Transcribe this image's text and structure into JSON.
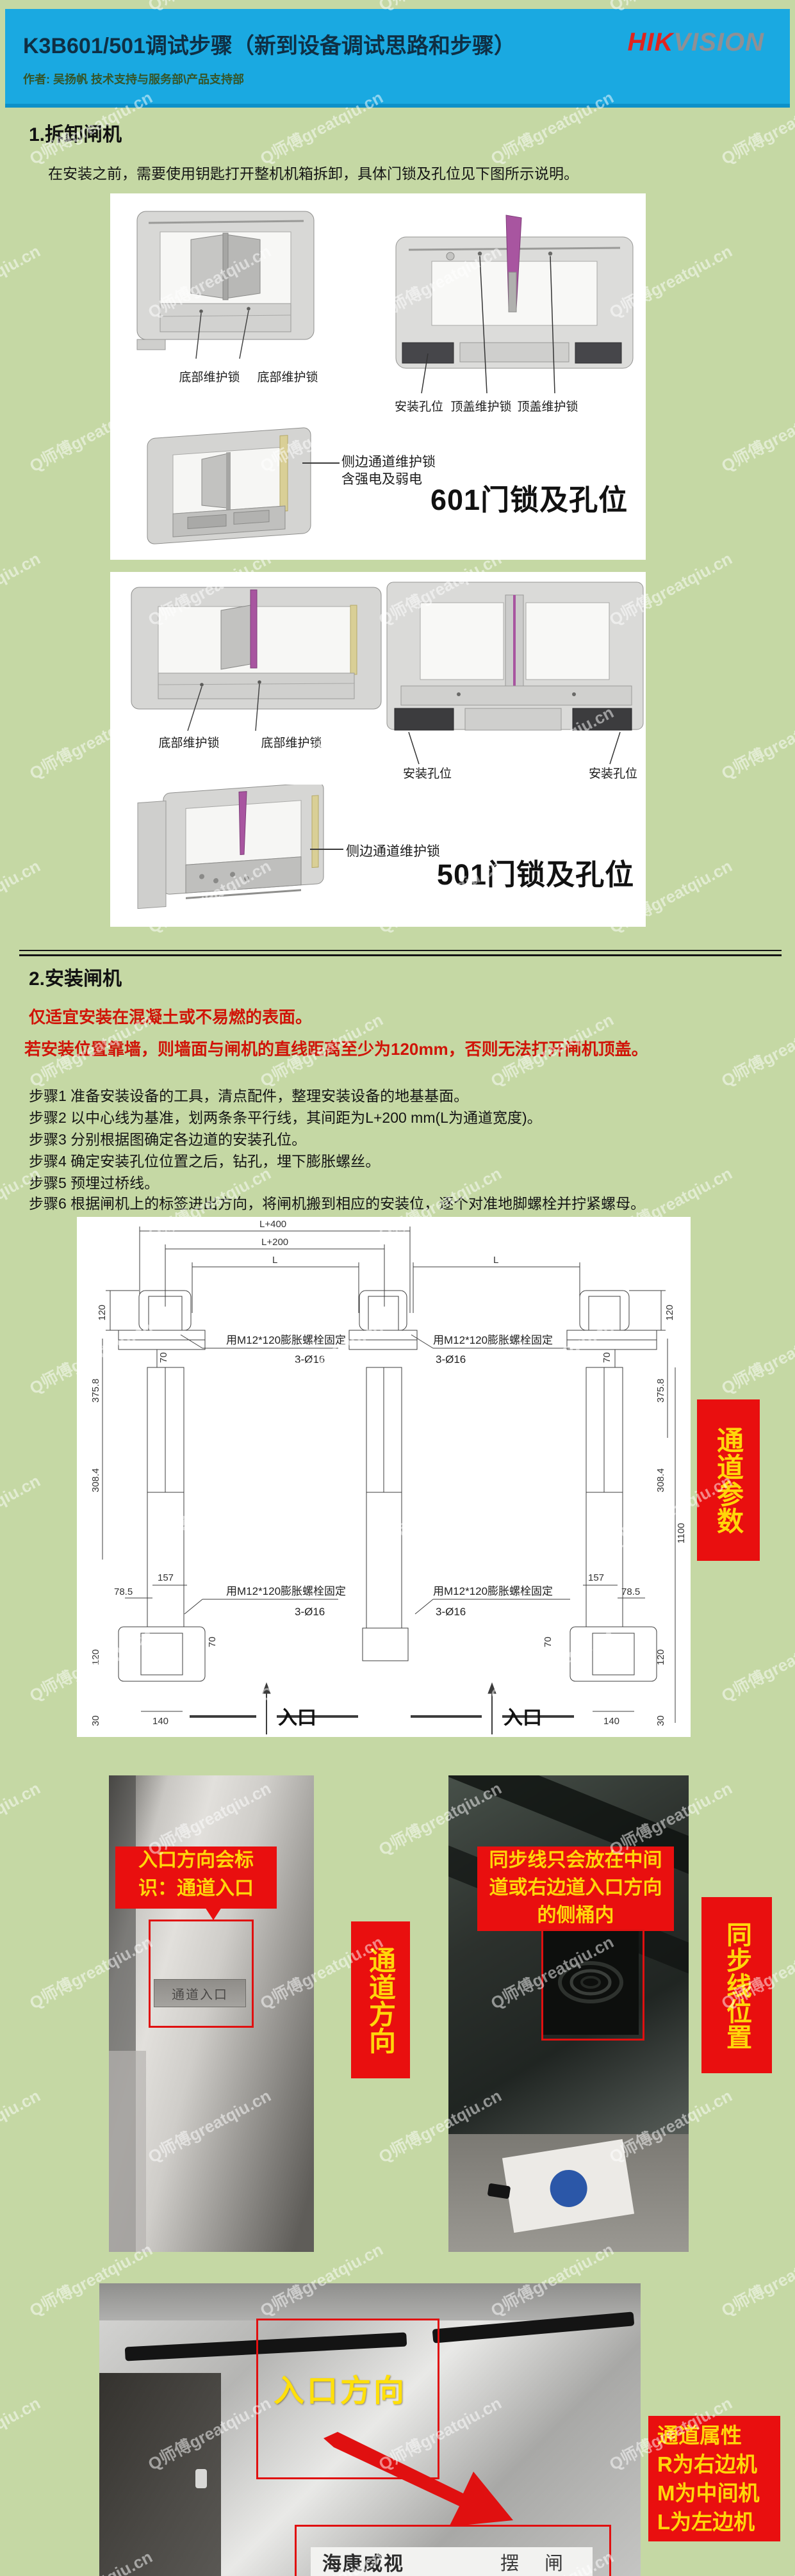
{
  "watermark": {
    "text": "Q师傅greatqiu.cn"
  },
  "header": {
    "title": "K3B601/501调试步骤（新到设备调试思路和步骤）",
    "author": "作者: 吴扬帆 技术支持与服务部\\产品支持部",
    "logo_hik": "HIK",
    "logo_vision": "VISION"
  },
  "section1": {
    "heading": "1.拆卸闸机",
    "intro": "在安装之前，需要使用钥匙打开整机机箱拆卸，具体门锁及孔位见下图所示说明。",
    "gate601": {
      "bottom_lock_left": "底部维护锁",
      "bottom_lock_right": "底部维护锁",
      "install_hole": "安装孔位",
      "top_lock_1": "顶盖维护锁",
      "top_lock_2": "顶盖维护锁",
      "side_lock_line1": "侧边通道维护锁",
      "side_lock_line2": "含强电及弱电",
      "caption": "601门锁及孔位"
    },
    "gate501": {
      "bottom_lock_left": "底部维护锁",
      "bottom_lock_right": "底部维护锁",
      "install_hole_left": "安装孔位",
      "install_hole_right": "安装孔位",
      "side_lock": "侧边通道维护锁",
      "caption": "501门锁及孔位"
    }
  },
  "section2": {
    "heading": "2.安装闸机",
    "warning1": "仅适宜安装在混凝土或不易燃的表面。",
    "warning2": "若安装位置靠墙，则墙面与闸机的直线距离至少为120mm，否则无法打开闸机顶盖。",
    "steps": [
      "步骤1 准备安装设备的工具，清点配件，整理安装设备的地基基面。",
      "步骤2 以中心线为基准，划两条条平行线，其间距为L+200 mm(L为通道宽度)。",
      "步骤3 分别根据图确定各边道的安装孔位。",
      "步骤4 确定安装孔位位置之后，钻孔，埋下膨胀螺丝。",
      "步骤5 预埋过桥线。",
      "步骤6 根据闸机上的标签进出方向，将闸机搬到相应的安装位，逐个对准地脚螺栓并拧紧螺母。"
    ]
  },
  "diagram": {
    "dim_l400": "L+400",
    "dim_l200": "L+200",
    "dim_l": "L",
    "dim_120": "120",
    "dim_70": "70",
    "dim_375_8": "375.8",
    "dim_308_4": "308.4",
    "dim_1100": "1100",
    "dim_157": "157",
    "dim_78_5": "78.5",
    "dim_140": "140",
    "dim_30": "30",
    "anchor_note": "用M12*120膨胀螺栓固定",
    "hole_note": "3-Ø16",
    "entrance": "入口",
    "side_tag": "通道参数"
  },
  "photos": {
    "entry_callout_line1": "入口方向会标",
    "entry_callout_line2": "识：通道入口",
    "entry_plate": "通道入口",
    "channel_dir_tag": "通道方向",
    "sync_callout_line1": "同步线只会放在中间",
    "sync_callout_line2": "道或右边道入口方向",
    "sync_callout_line3": "的侧桶内",
    "sync_tag": "同步线位置",
    "entry_dir_label": "入口方向",
    "attr_line1": "通道属性",
    "attr_line2": "R为右边机",
    "attr_line3": "M为中间机",
    "attr_line4": "L为左边机",
    "brand": "海康威视",
    "gate_word": "摆  闸"
  }
}
